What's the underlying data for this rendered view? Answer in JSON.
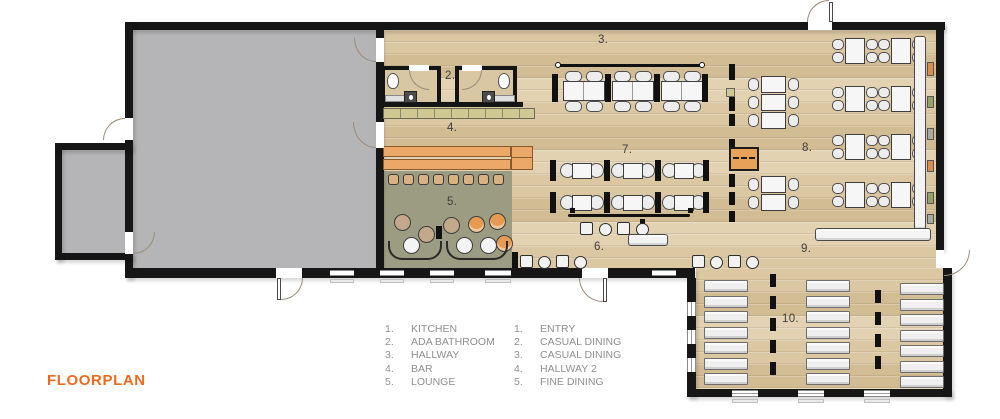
{
  "title": "FLOORPLAN",
  "legend": {
    "left": [
      {
        "num": "1.",
        "label": "KITCHEN"
      },
      {
        "num": "2.",
        "label": "ADA BATHROOM"
      },
      {
        "num": "3.",
        "label": "HALLWAY"
      },
      {
        "num": "4.",
        "label": "BAR"
      },
      {
        "num": "5.",
        "label": "LOUNGE"
      }
    ],
    "right": [
      {
        "num": "1.",
        "label": "ENTRY"
      },
      {
        "num": "2.",
        "label": "CASUAL DINING"
      },
      {
        "num": "3.",
        "label": "CASUAL DINING"
      },
      {
        "num": "4.",
        "label": "HALLWAY 2"
      },
      {
        "num": "5.",
        "label": "FINE DINING"
      }
    ]
  },
  "plan_labels": {
    "ada_bathroom": "2.",
    "hallway": "3.",
    "bar": "4.",
    "lounge": "5.",
    "entry": "6.",
    "casual_dining_1": "7.",
    "casual_dining_2": "8.",
    "hallway_2": "9.",
    "fine_dining": "10."
  },
  "colors": {
    "wall": "#161616",
    "wood_floor": "#dbc7a1",
    "kitchen_gray": "#b5b5b7",
    "lounge_olive": "#9c9c82",
    "bar_orange": "#eca869",
    "accent_orange": "#ed6b21",
    "legend_text": "#8f8f8f"
  }
}
